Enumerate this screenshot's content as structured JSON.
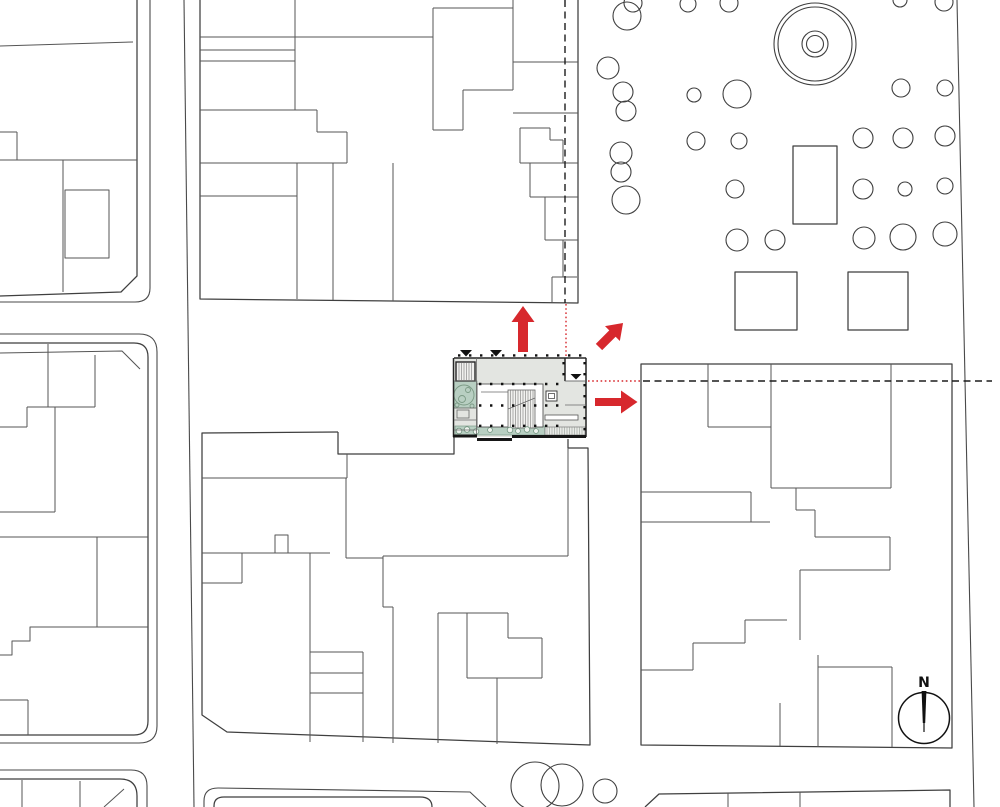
{
  "scene": {
    "type": "architectural-site-plan",
    "description": "Black and white urban site plan with a highlighted ground-floor plan of the project building, red arrows indicating views/connections toward the park, dashed sight lines, tree-filled park at top right and a north compass at bottom right."
  },
  "compass": {
    "label": "N"
  },
  "colors": {
    "red": "#d7282d",
    "site_fill": "#e3e5e1",
    "green": "#b8cfc2",
    "green_dark": "#7b9a85",
    "line": "#3f3f3f",
    "wall": "#1c1c1c",
    "white": "#ffffff"
  },
  "arrows": [
    {
      "name": "arrow-up",
      "direction": "up"
    },
    {
      "name": "arrow-diagonal",
      "direction": "up-right"
    },
    {
      "name": "arrow-right",
      "direction": "right"
    }
  ],
  "sight_lines": [
    {
      "name": "vertical-sight-line",
      "style": "black-dashed + red-dotted",
      "orientation": "vertical"
    },
    {
      "name": "horizontal-sight-line",
      "style": "red-dotted + black-dashed",
      "orientation": "horizontal"
    }
  ],
  "features": {
    "park": "grove of trees with circular fountain, pavilion rectangle and two square platforms",
    "site_building": "ground floor plan with entry courtyard, main stair, elevator, planted strip and green patio",
    "markers": "three black entrance triangles"
  }
}
